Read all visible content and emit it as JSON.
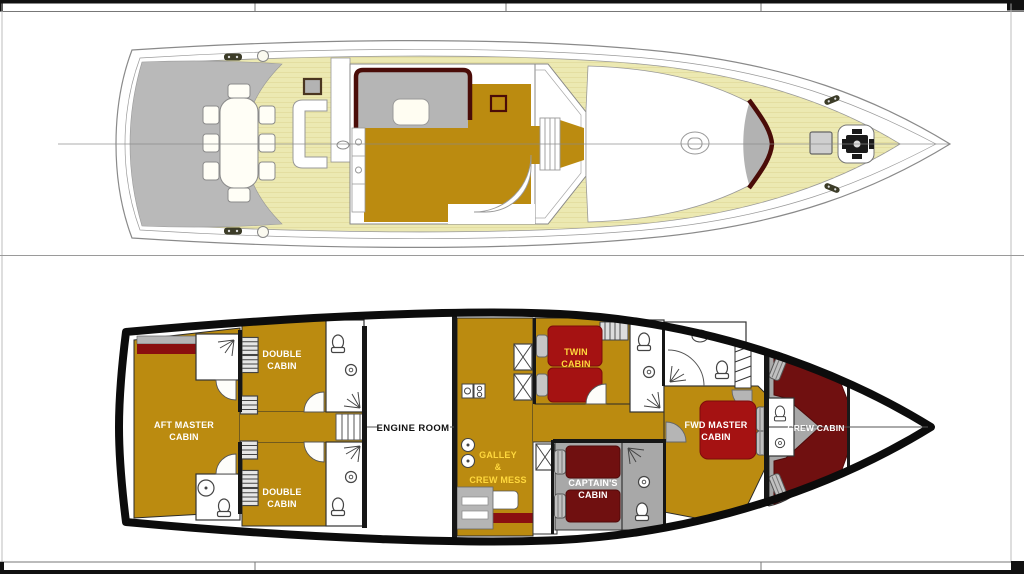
{
  "page": {
    "background": "#ffffff"
  },
  "palette": {
    "deck_teak": "#ece9b2",
    "transom_gray": "#b9b9b9",
    "floor_gold": "#bb8b10",
    "bed_red": "#a51212",
    "berth_maroon": "#701010",
    "floor_gray": "#a8a8a8",
    "trim_maroon": "#4a0c08",
    "hull_black": "#0c0c0c",
    "label_yellow": "#ffd83d",
    "label_white": "#ffffff",
    "label_black": "#111111"
  },
  "lower_deck": {
    "cabins": [
      {
        "id": "aft-master-cabin",
        "label_lines": [
          "AFT MASTER",
          "CABIN"
        ]
      },
      {
        "id": "double-cabin-port",
        "label_lines": [
          "DOUBLE",
          "CABIN"
        ]
      },
      {
        "id": "double-cabin-starboard",
        "label_lines": [
          "DOUBLE",
          "CABIN"
        ]
      },
      {
        "id": "engine-room",
        "label_lines": [
          "ENGINE ROOM"
        ]
      },
      {
        "id": "galley-crew-mess",
        "label_lines": [
          "GALLEY",
          "&",
          "CREW MESS"
        ]
      },
      {
        "id": "twin-cabin",
        "label_lines": [
          "TWIN",
          "CABIN"
        ]
      },
      {
        "id": "captains-cabin",
        "label_lines": [
          "CAPTAIN'S",
          "CABIN"
        ]
      },
      {
        "id": "fwd-master-cabin",
        "label_lines": [
          "FWD MASTER",
          "CABIN"
        ]
      },
      {
        "id": "crew-cabin",
        "label_lines": [
          "CREW CABIN"
        ]
      }
    ]
  }
}
